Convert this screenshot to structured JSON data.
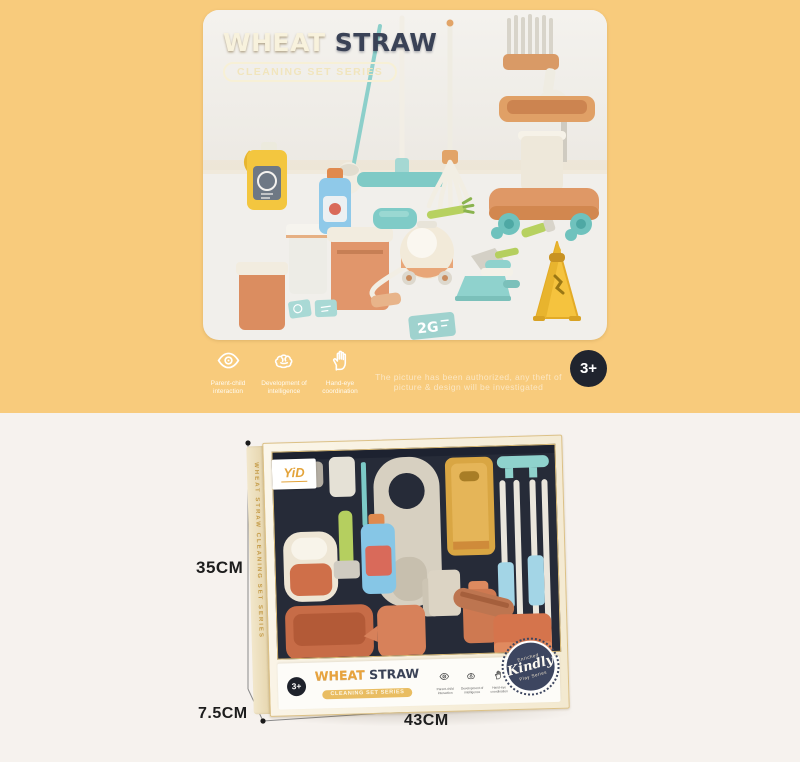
{
  "hero": {
    "title_part1": "WHEAT",
    "title_part2": "STRAW",
    "subtitle": "CLEANING SET SERIES",
    "age_badge": "3+",
    "watermark": "The picture has been authorized, any theft of picture & design will be investigated",
    "card_text": "2G",
    "features": [
      {
        "name": "parent-child-interaction",
        "line1": "Parent-child",
        "line2": "interaction"
      },
      {
        "name": "development-of-intelligence",
        "line1": "Development of",
        "line2": "intelligence"
      },
      {
        "name": "hand-eye-coordination",
        "line1": "Hand-eye",
        "line2": "coordination"
      }
    ]
  },
  "box": {
    "brand_label": "YiD",
    "side_text": "WHEAT STRAW CLEANING SET SERIES",
    "title_part1": "WHEAT",
    "title_part2": "STRAW",
    "subtitle": "CLEANING SET SERIES",
    "age_badge": "3+",
    "stamp": {
      "top": "Enriched",
      "main": "Kindly",
      "bottom": "Play Series"
    }
  },
  "dimensions": {
    "height_label": "35CM",
    "depth_label": "7.5CM",
    "width_label": "43CM"
  },
  "colors": {
    "hero_bg": "#f8cb7c",
    "lower_bg": "#f6f2ee",
    "navy": "#3a4256",
    "gold": "#e6a83c",
    "teal": "#7fcac6",
    "orange": "#df9568",
    "caution_yellow": "#f5c33e",
    "badge_dark": "#20242e"
  }
}
